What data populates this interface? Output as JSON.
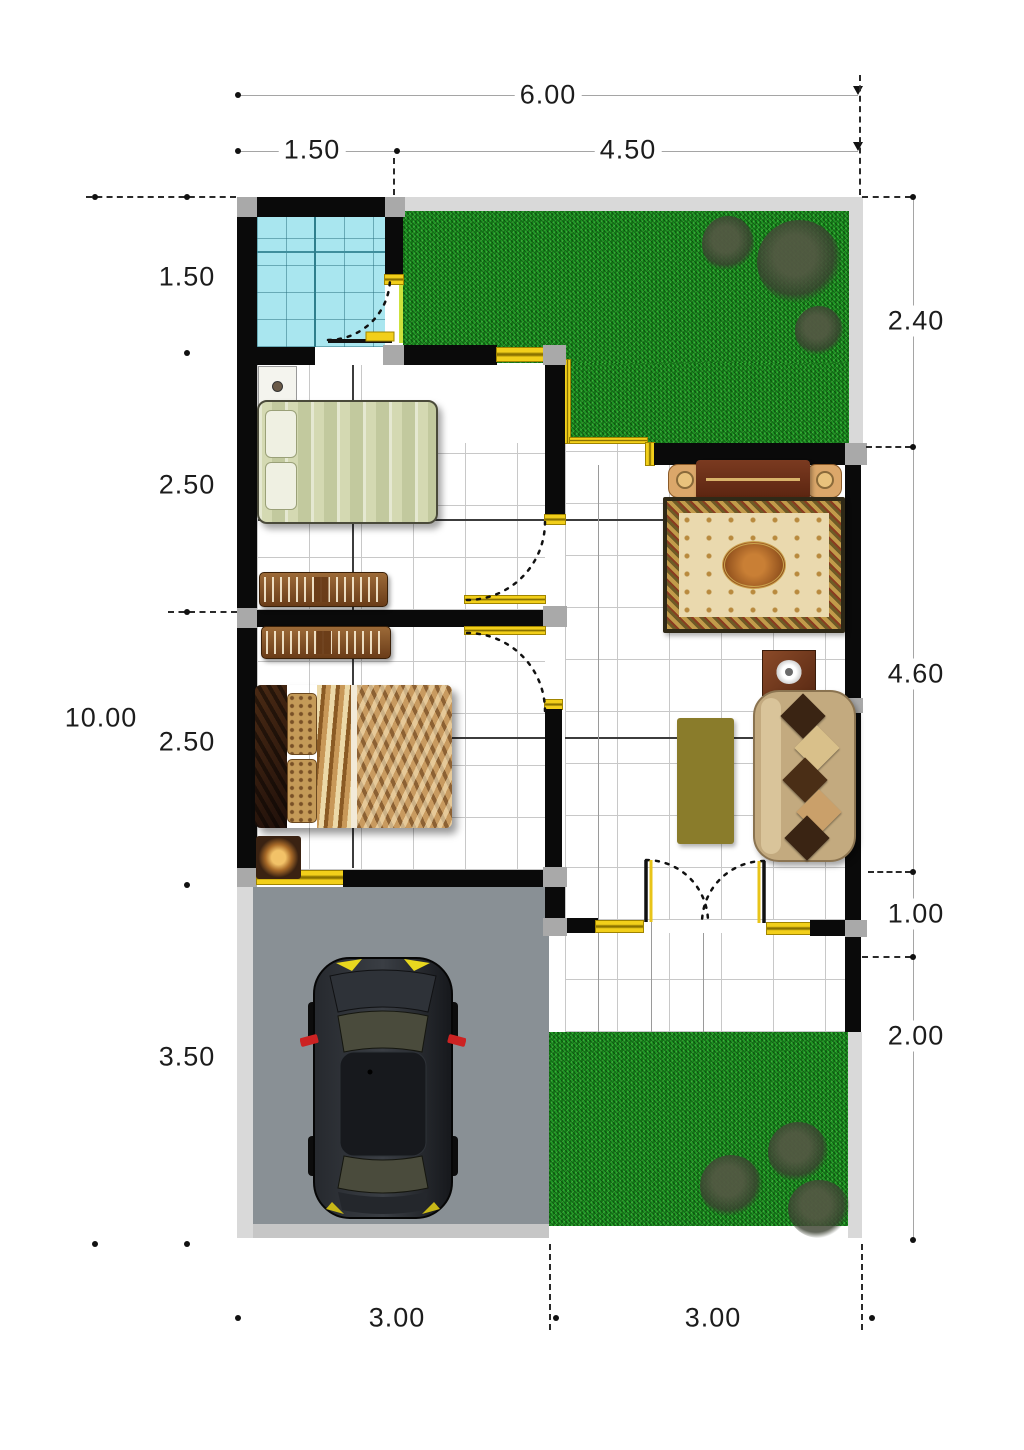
{
  "title": "house-floor-plan",
  "dims": {
    "top": {
      "total": "6.00",
      "segments": [
        "1.50",
        "4.50"
      ]
    },
    "left": {
      "total": "10.00",
      "segments": [
        "1.50",
        "2.50",
        "2.50",
        "3.50"
      ]
    },
    "right": {
      "segments": [
        "2.40",
        "4.60",
        "1.00",
        "2.00"
      ]
    },
    "bottom": {
      "segments": [
        "3.00",
        "3.00"
      ]
    }
  },
  "colors": {
    "wall": "#0a0a0a",
    "column": "#a9a9a9",
    "window_marker": "#f2cf1a",
    "grass": "#1b8c1f",
    "bath_tile": "#a9e6ef",
    "carport": "#899095",
    "rug_border": "#2f2917",
    "rug_field": "#ead9ae",
    "sofa": "#c3aa7f",
    "coffee_table": "#8a7c2b",
    "car_body": "#1a1c20",
    "mirror_red": "#cc2222"
  },
  "elements": {
    "rooms": [
      "bathroom",
      "bedroom-1",
      "bedroom-2",
      "living-hall",
      "terrace",
      "carport",
      "garden-front",
      "garden-back"
    ],
    "furniture": [
      "single-bed",
      "double-bed",
      "wardrobe-rack",
      "wardrobe-rack",
      "console-table",
      "area-rug",
      "sofa",
      "coffee-table",
      "side-table",
      "nightstand",
      "nightstand",
      "car"
    ]
  }
}
